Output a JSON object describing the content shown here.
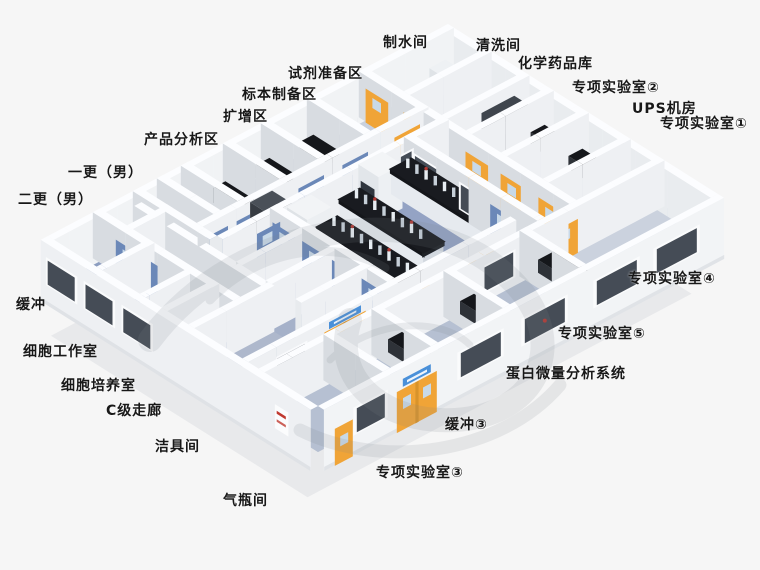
{
  "labels": [
    {
      "text": "制水间"
    },
    {
      "text": "清洗间"
    },
    {
      "text": "化学药品库"
    },
    {
      "text": "专项实验室②"
    },
    {
      "text": "UPS机房"
    },
    {
      "text": "专项实验室①"
    },
    {
      "text": "试剂准备区"
    },
    {
      "text": "标本制备区"
    },
    {
      "text": "扩增区"
    },
    {
      "text": "产品分析区"
    },
    {
      "text": "一更（男）"
    },
    {
      "text": "二更（男）"
    },
    {
      "text": "缓冲"
    },
    {
      "text": "细胞工作室"
    },
    {
      "text": "细胞培养室"
    },
    {
      "text": "C级走廊"
    },
    {
      "text": "洁具间"
    },
    {
      "text": "气瓶间"
    },
    {
      "text": "专项实验室④"
    },
    {
      "text": "专项实验室⑤"
    },
    {
      "text": "蛋白微量分析系统"
    },
    {
      "text": "缓冲③"
    },
    {
      "text": "专项实验室③"
    }
  ],
  "colors": {
    "background": "#f6f6f6",
    "wall_top": "#fcfdff",
    "wall_face_light": "#eef0f3",
    "wall_face_shade": "#d8dce1",
    "wall_exterior": "#f2f4f6",
    "floor_base": "#aeb8cc",
    "floor_corridor": "#b4bdd2",
    "floor_lab": "#94a3c4",
    "floor_room": "#c9d1de",
    "floor_cell": "#8c9dc0",
    "door_yellow": "#f0a437",
    "door_blue": "#6b88b8",
    "door_window": "#c8d9e8",
    "glass_dark": "#454c56",
    "bench_top": "#191b20",
    "bench_body": "#e6eaef",
    "sign_blue": "#4a90d9",
    "sign_red": "#c0392f",
    "shadow": "#dcdee1",
    "watermark": "#7e858c"
  }
}
